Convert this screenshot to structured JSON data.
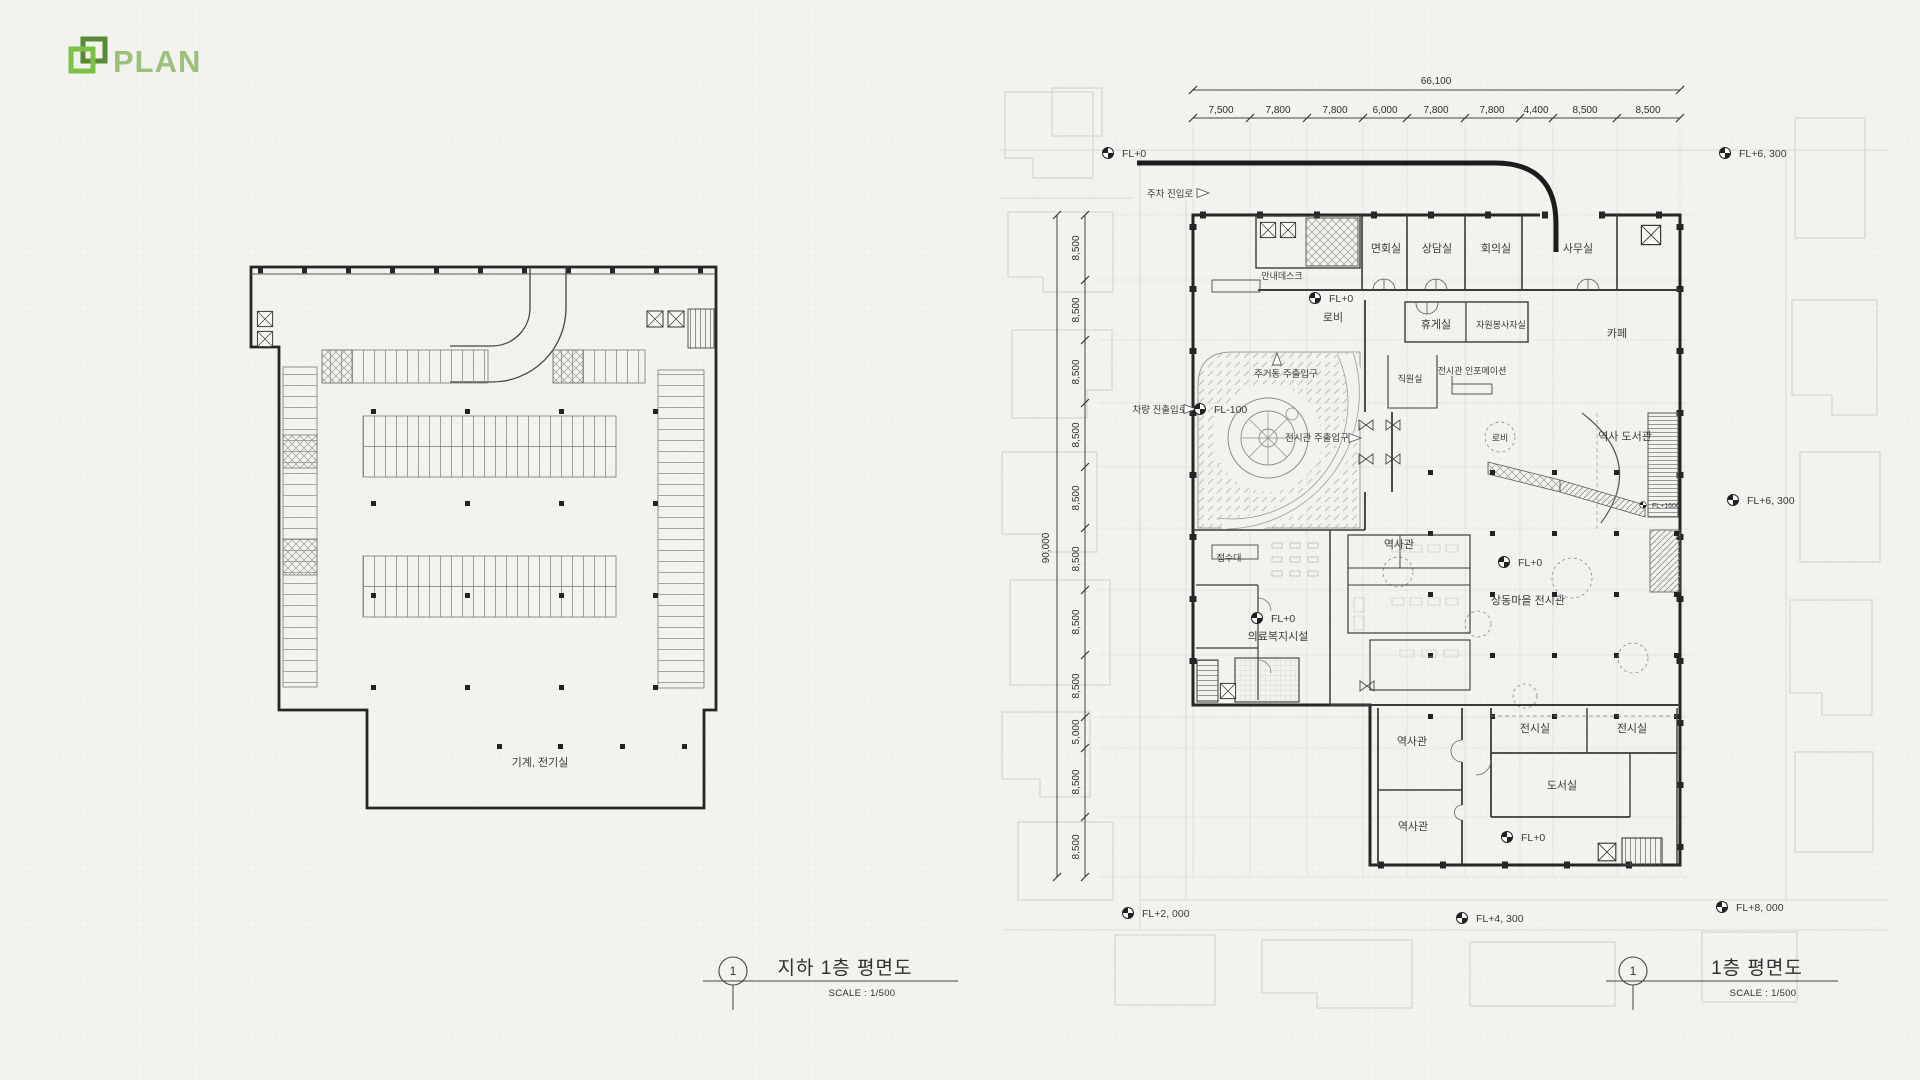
{
  "logo": {
    "text": "PLAN",
    "accent_green": "#7cc142",
    "dark_green": "#568b33"
  },
  "left_plan": {
    "room_label": "기계, 전기실",
    "title": {
      "number": "1",
      "text": "지하 1층 평면도",
      "scale": "SCALE : 1/500"
    }
  },
  "right_plan": {
    "title": {
      "number": "1",
      "text": "1층 평면도",
      "scale": "SCALE : 1/500"
    },
    "dims_top": {
      "total": "66,100",
      "segments": [
        "7,500",
        "7,800",
        "7,800",
        "6,000",
        "7,800",
        "7,800",
        "4,400",
        "8,500",
        "8,500"
      ]
    },
    "dims_left": {
      "total": "90,000",
      "segments": [
        "8,500",
        "8,500",
        "8,500",
        "8,500",
        "8,500",
        "8,500",
        "8,500",
        "8,500",
        "5,000",
        "8,500",
        "8,500"
      ]
    },
    "levels": {
      "site_nw": "FL+0",
      "site_ne": "FL+6, 300",
      "site_e": "FL+6, 300",
      "site_sw": "FL+2, 000",
      "site_s": "FL+4, 300",
      "site_se": "FL+8, 000",
      "lobby": "FL+0",
      "plaza": "FL-100",
      "ramp": "FL+1600",
      "hall": "FL+0",
      "medical": "FL+0",
      "south": "FL+0"
    },
    "leaders": {
      "parking_entry": "주차 진입로",
      "vehicle_entry": "차량 진출입로",
      "residential_entrance": "주거동 주출입구",
      "exhibition_entrance": "전시관 주출입구"
    },
    "rooms": {
      "visiting": "면회실",
      "counsel": "상담실",
      "meeting": "회의실",
      "office": "사무실",
      "info_desk": "안내데스크",
      "lobby_n": "로비",
      "lounge": "휴게실",
      "volunteer": "자원봉사자실",
      "cafe": "카페",
      "staff": "직원실",
      "exhibit_info": "전시관 인포메이션",
      "lobby_c": "로비",
      "history_library": "역사 도서관",
      "history_hall": "역사관",
      "village_exhibit": "상동마을 전시관",
      "reception": "접수대",
      "medical": "의료복지시설",
      "history_hall_s1": "역사관",
      "history_hall_s2": "역사관",
      "exhibit_1": "전시실",
      "exhibit_2": "전시실",
      "library": "도서실"
    }
  }
}
